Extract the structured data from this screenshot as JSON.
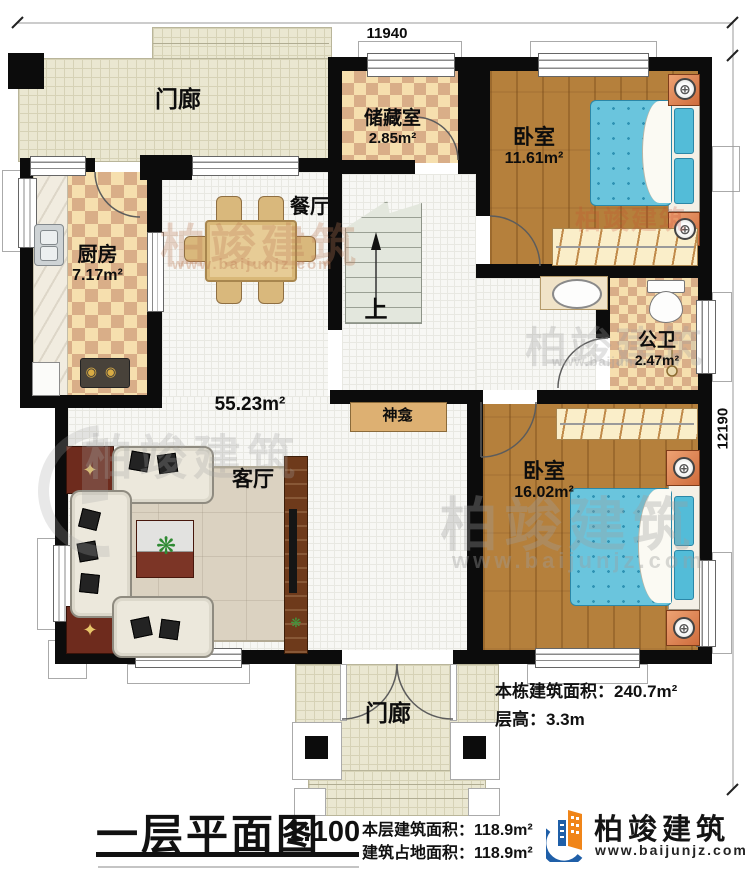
{
  "dimensions": {
    "width_mm": "11940",
    "height_mm": "12190"
  },
  "rooms": {
    "porch_top": {
      "label": "门廊"
    },
    "storage": {
      "label": "储藏室",
      "area": "2.85m²"
    },
    "bedroom1": {
      "label": "卧室",
      "area": "11.61m²"
    },
    "kitchen": {
      "label": "厨房",
      "area": "7.17m²"
    },
    "dining": {
      "label": "餐厅"
    },
    "hall": {
      "area": "55.23m²"
    },
    "living": {
      "label": "客厅"
    },
    "shrine": {
      "label": "神龛"
    },
    "bathroom": {
      "label": "公卫",
      "area": "2.47m²"
    },
    "bedroom2": {
      "label": "卧室",
      "area": "16.02m²"
    },
    "porch_bottom": {
      "label": "门廊"
    },
    "stairs": {
      "up_label": "上"
    }
  },
  "annotations": {
    "building_total_area": "本栋建筑面积：240.7m²",
    "floor_height": "层高：3.3m"
  },
  "footer": {
    "title": "一层平面图",
    "scale": "1:100",
    "floor_area_line": "本层建筑面积：118.9m²",
    "footprint_line": "建筑占地面积：118.9m²"
  },
  "branding": {
    "company": "柏竣建筑",
    "website": "www.baijunjz.com"
  },
  "watermarks": {
    "company": "柏竣建筑",
    "website": "www.baijunjz.com"
  },
  "icons": {
    "lamp": "⊕",
    "star": "✦",
    "plant": "❋",
    "burner": "◉"
  },
  "colors": {
    "wall": "#0c0c0c",
    "wood": "#b5803c",
    "bed": "#6ac5dd",
    "brand_blue": "#1f5fa8",
    "brand_orange": "#f08519"
  }
}
